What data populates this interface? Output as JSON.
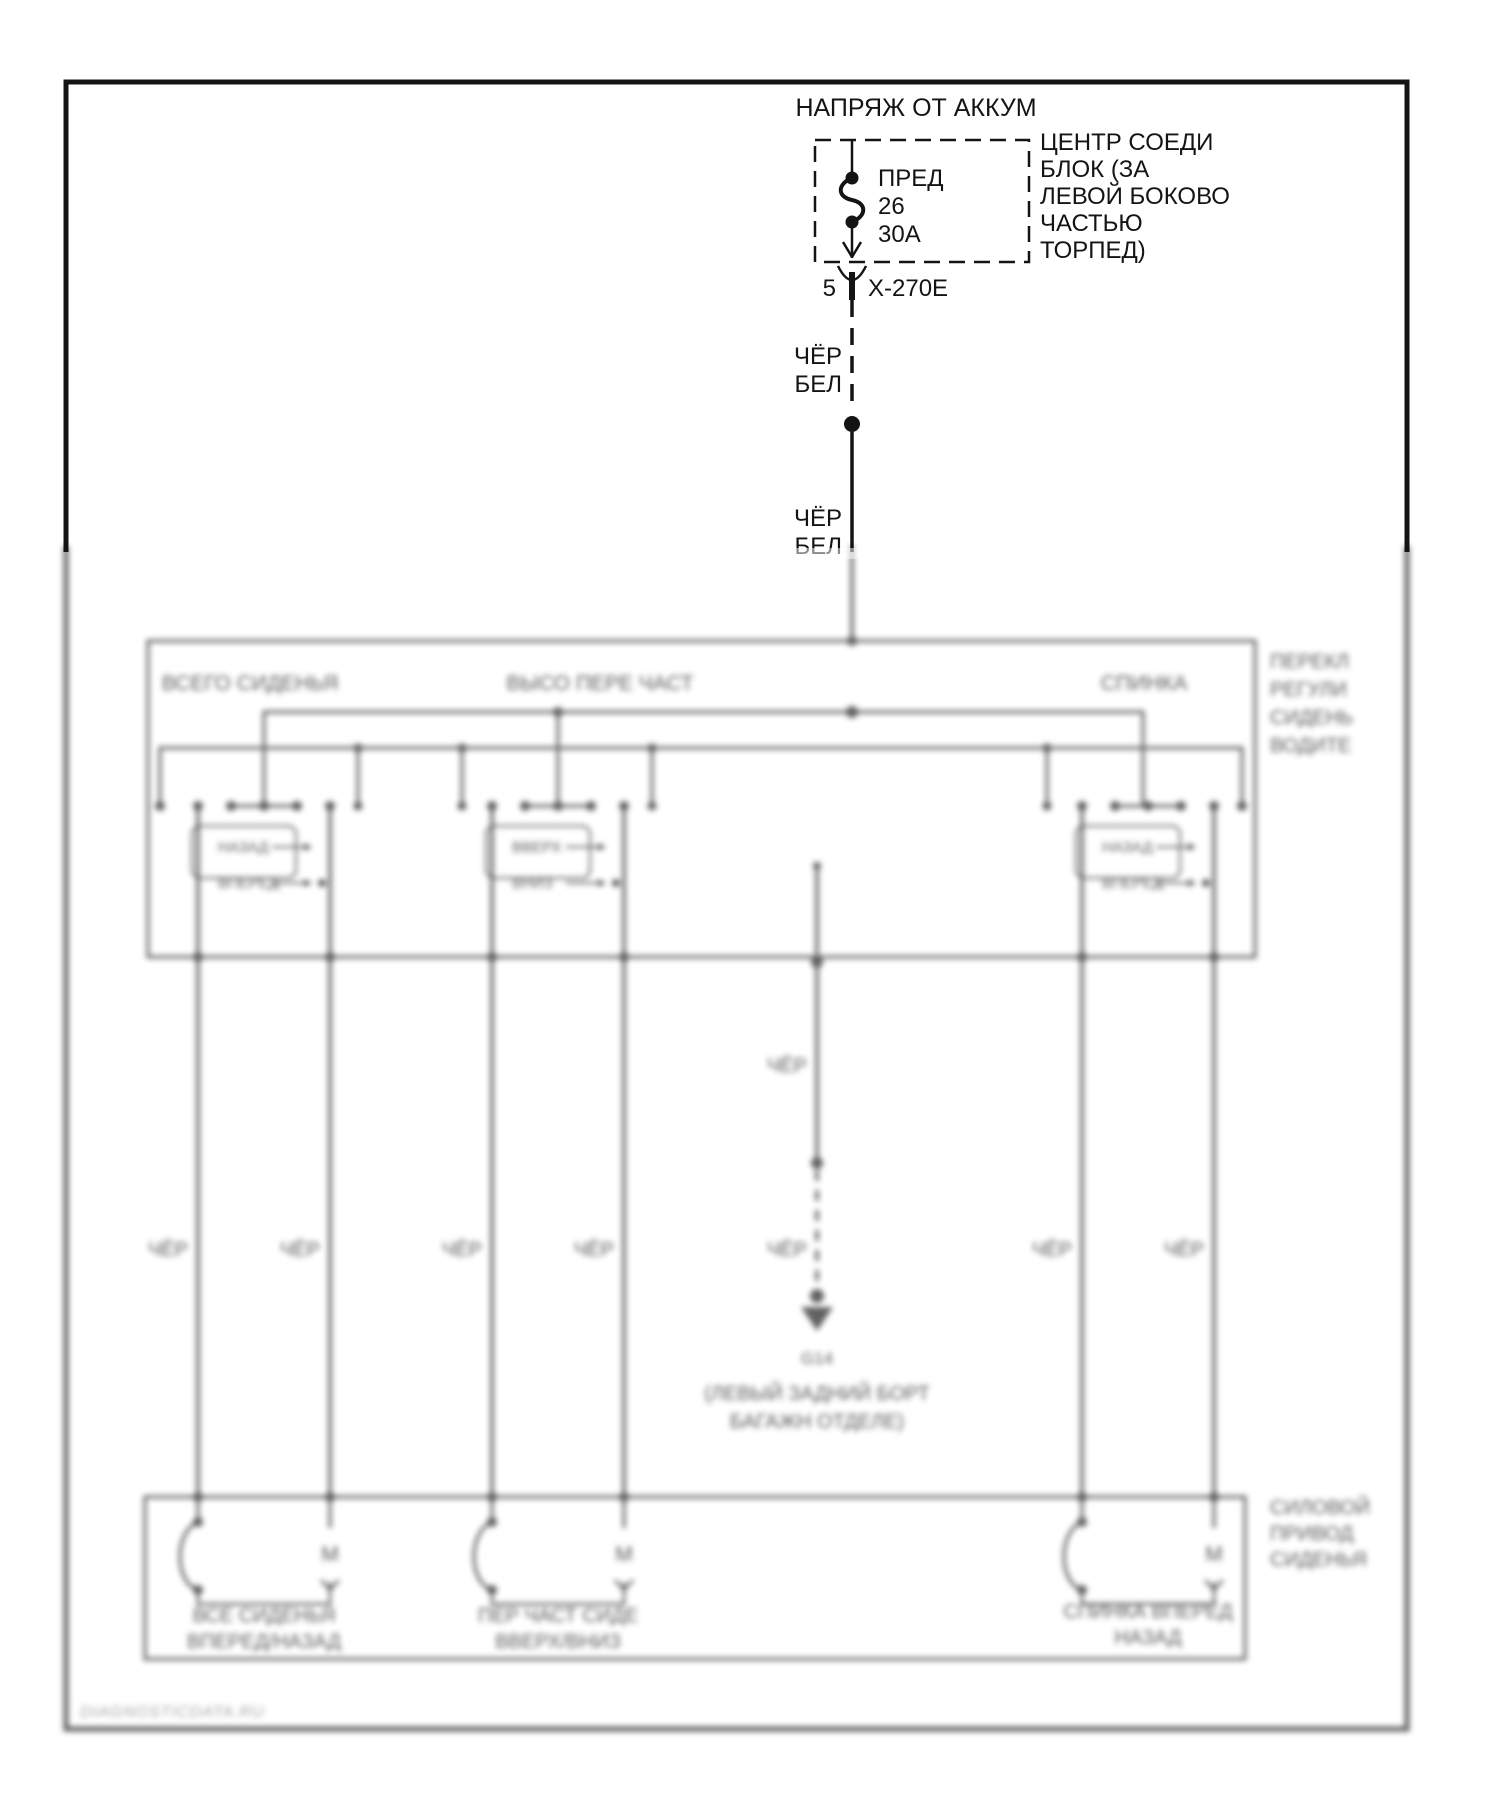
{
  "colors": {
    "ink": "#141414",
    "blur_ink": "#3f3f3f",
    "paper": "#ffffff"
  },
  "top": {
    "power_source": "НАПРЯЖ ОТ АККУМ",
    "fuse_name": "ПРЕД",
    "fuse_number": "26",
    "fuse_rating": "30А",
    "block_line1": "ЦЕНТР СОЕДИ",
    "block_line2": "БЛОК (ЗА",
    "block_line3": "ЛЕВОЙ БОКОВО",
    "block_line4": "ЧАСТЬЮ",
    "block_line5": "ТОРПЕД)",
    "connector_pin": "5",
    "connector_id": "X-270E",
    "wire_color_1": "ЧЁР",
    "wire_color_2": "БЕЛ"
  },
  "switch_box": {
    "label_whole_seat": "ВСЕГО СИДЕНЬЯ",
    "label_front_height": "ВЫСО ПЕРЕ ЧАСТ",
    "label_recline": "СПИНКА",
    "unit_line1": "ПЕРЕКЛ",
    "unit_line2": "РЕГУЛИ",
    "unit_line3": "СИДЕНЬ",
    "unit_line4": "ВОДИТЕ",
    "pos": [
      {
        "a": "НАЗАД",
        "b": "ВПЕРЕД"
      },
      {
        "a": "ВВЕРХ",
        "b": "ВНИЗ"
      },
      {
        "a": "НАЗАД",
        "b": "ВПЕРЕД"
      }
    ]
  },
  "wires": {
    "ground_color": "ЧЁР"
  },
  "ground": {
    "id": "G14",
    "loc_line1": "(ЛЕВЫЙ ЗАДНИЙ БОРТ",
    "loc_line2": "БАГАЖН ОТДЕЛЕ)"
  },
  "motor_box": {
    "unit_line1": "СИЛОВОЙ",
    "unit_line2": "ПРИВОД",
    "unit_line3": "СИДЕНЬЯ",
    "motor_symbol": "M",
    "motors": [
      {
        "line1": "ВСЕ СИДЕНЬЯ",
        "line2": "ВПЕРЕД/НАЗАД"
      },
      {
        "line1": "ПЕР ЧАСТ СИДЕ",
        "line2": "ВВЕРХ/ВНИЗ"
      },
      {
        "line1": "СПИНКА ВПЕРЕД",
        "line2": "НАЗАД"
      }
    ]
  },
  "watermark": "DIAGNOSTICDATA.RU"
}
